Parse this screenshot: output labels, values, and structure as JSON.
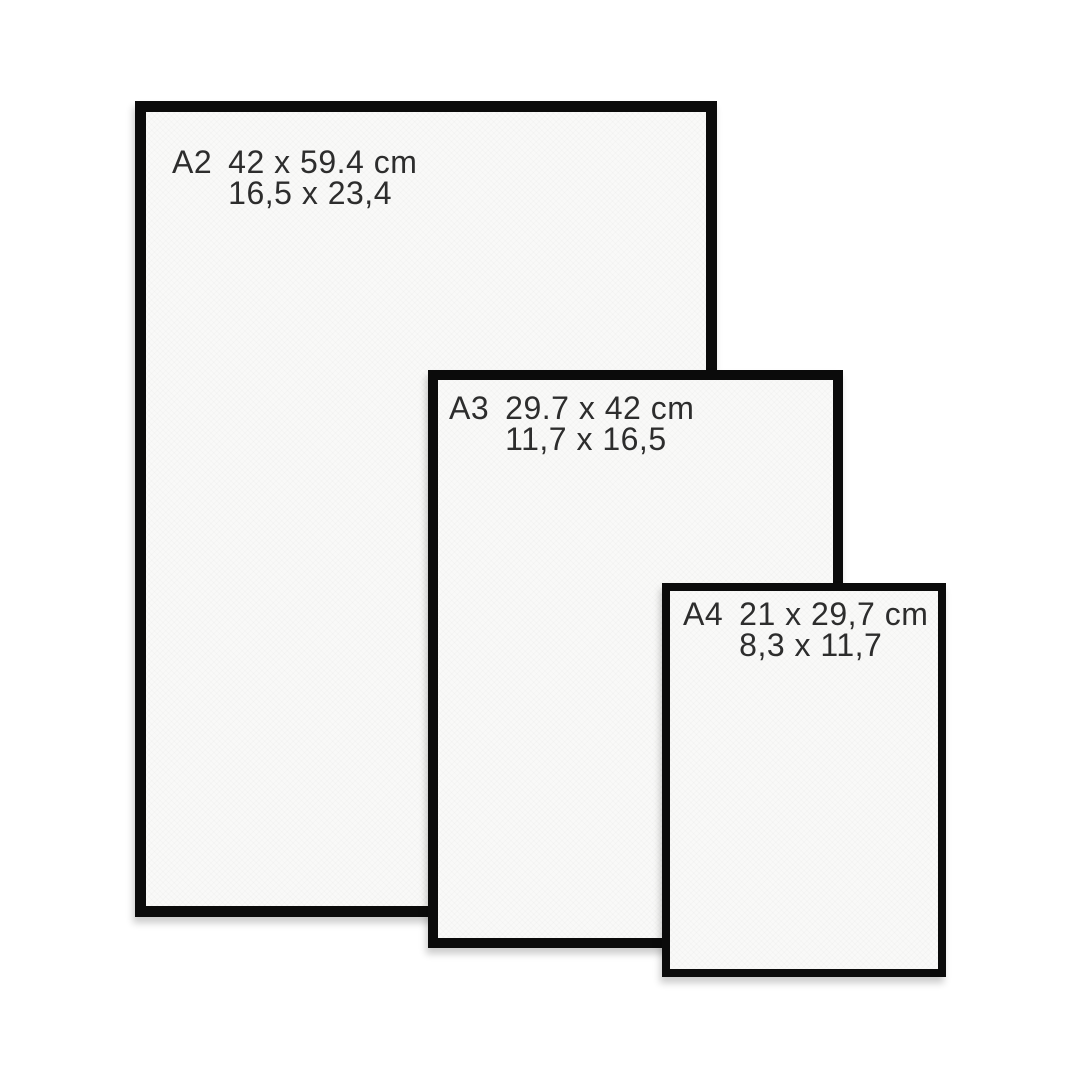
{
  "image": {
    "description": "Paper size comparison diagram with three black frames",
    "background_color": "#ffffff"
  },
  "colors": {
    "frame_border": "#0b0b0b",
    "paper": "#f9f9f8",
    "text": "#2d2d2d"
  },
  "frames": [
    {
      "id": "a2",
      "label": "A2",
      "cm": "42 x 59.4 cm",
      "inches": "16,5 x 23,4"
    },
    {
      "id": "a3",
      "label": "A3",
      "cm": "29.7 x 42 cm",
      "inches": "11,7 x 16,5"
    },
    {
      "id": "a4",
      "label": "A4",
      "cm": "21 x 29,7 cm",
      "inches": "8,3 x 11,7"
    }
  ]
}
